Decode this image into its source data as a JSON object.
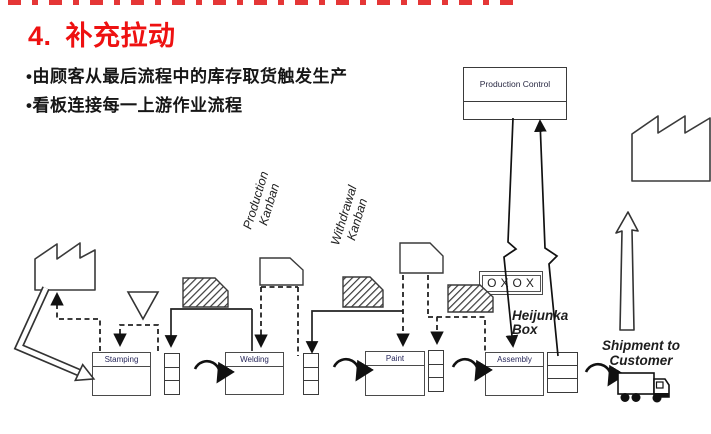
{
  "slide": {
    "title_number": "4.",
    "title_text": "补充拉动",
    "bullets": [
      "•由顾客从最后流程中的库存取货触发生产",
      "•看板连接每一上游作业流程"
    ]
  },
  "diagram": {
    "supplier_label": "Steel Supplier",
    "production_control_label": "Production Control",
    "customer_label": "Customer",
    "processes": [
      "Stamping",
      "Welding",
      "Paint",
      "Assembly"
    ],
    "kanban_labels": {
      "production": "Production Kanban",
      "withdrawal": "Withdrawal Kanban"
    },
    "heijunka_label": "Heijunka Box",
    "heijunka_symbols": "OXOX",
    "shipment_label": "Shipment to Customer",
    "icons": [
      "factory-icon",
      "truck-icon",
      "kanban-card-icon",
      "inventory-triangle-icon",
      "withdrawal-loop-icon",
      "lightning-line-icon",
      "push-arrow-icon"
    ],
    "colors": {
      "title_red": "#ee1111",
      "line_dark": "#222222",
      "label_navy": "#26265a"
    }
  }
}
